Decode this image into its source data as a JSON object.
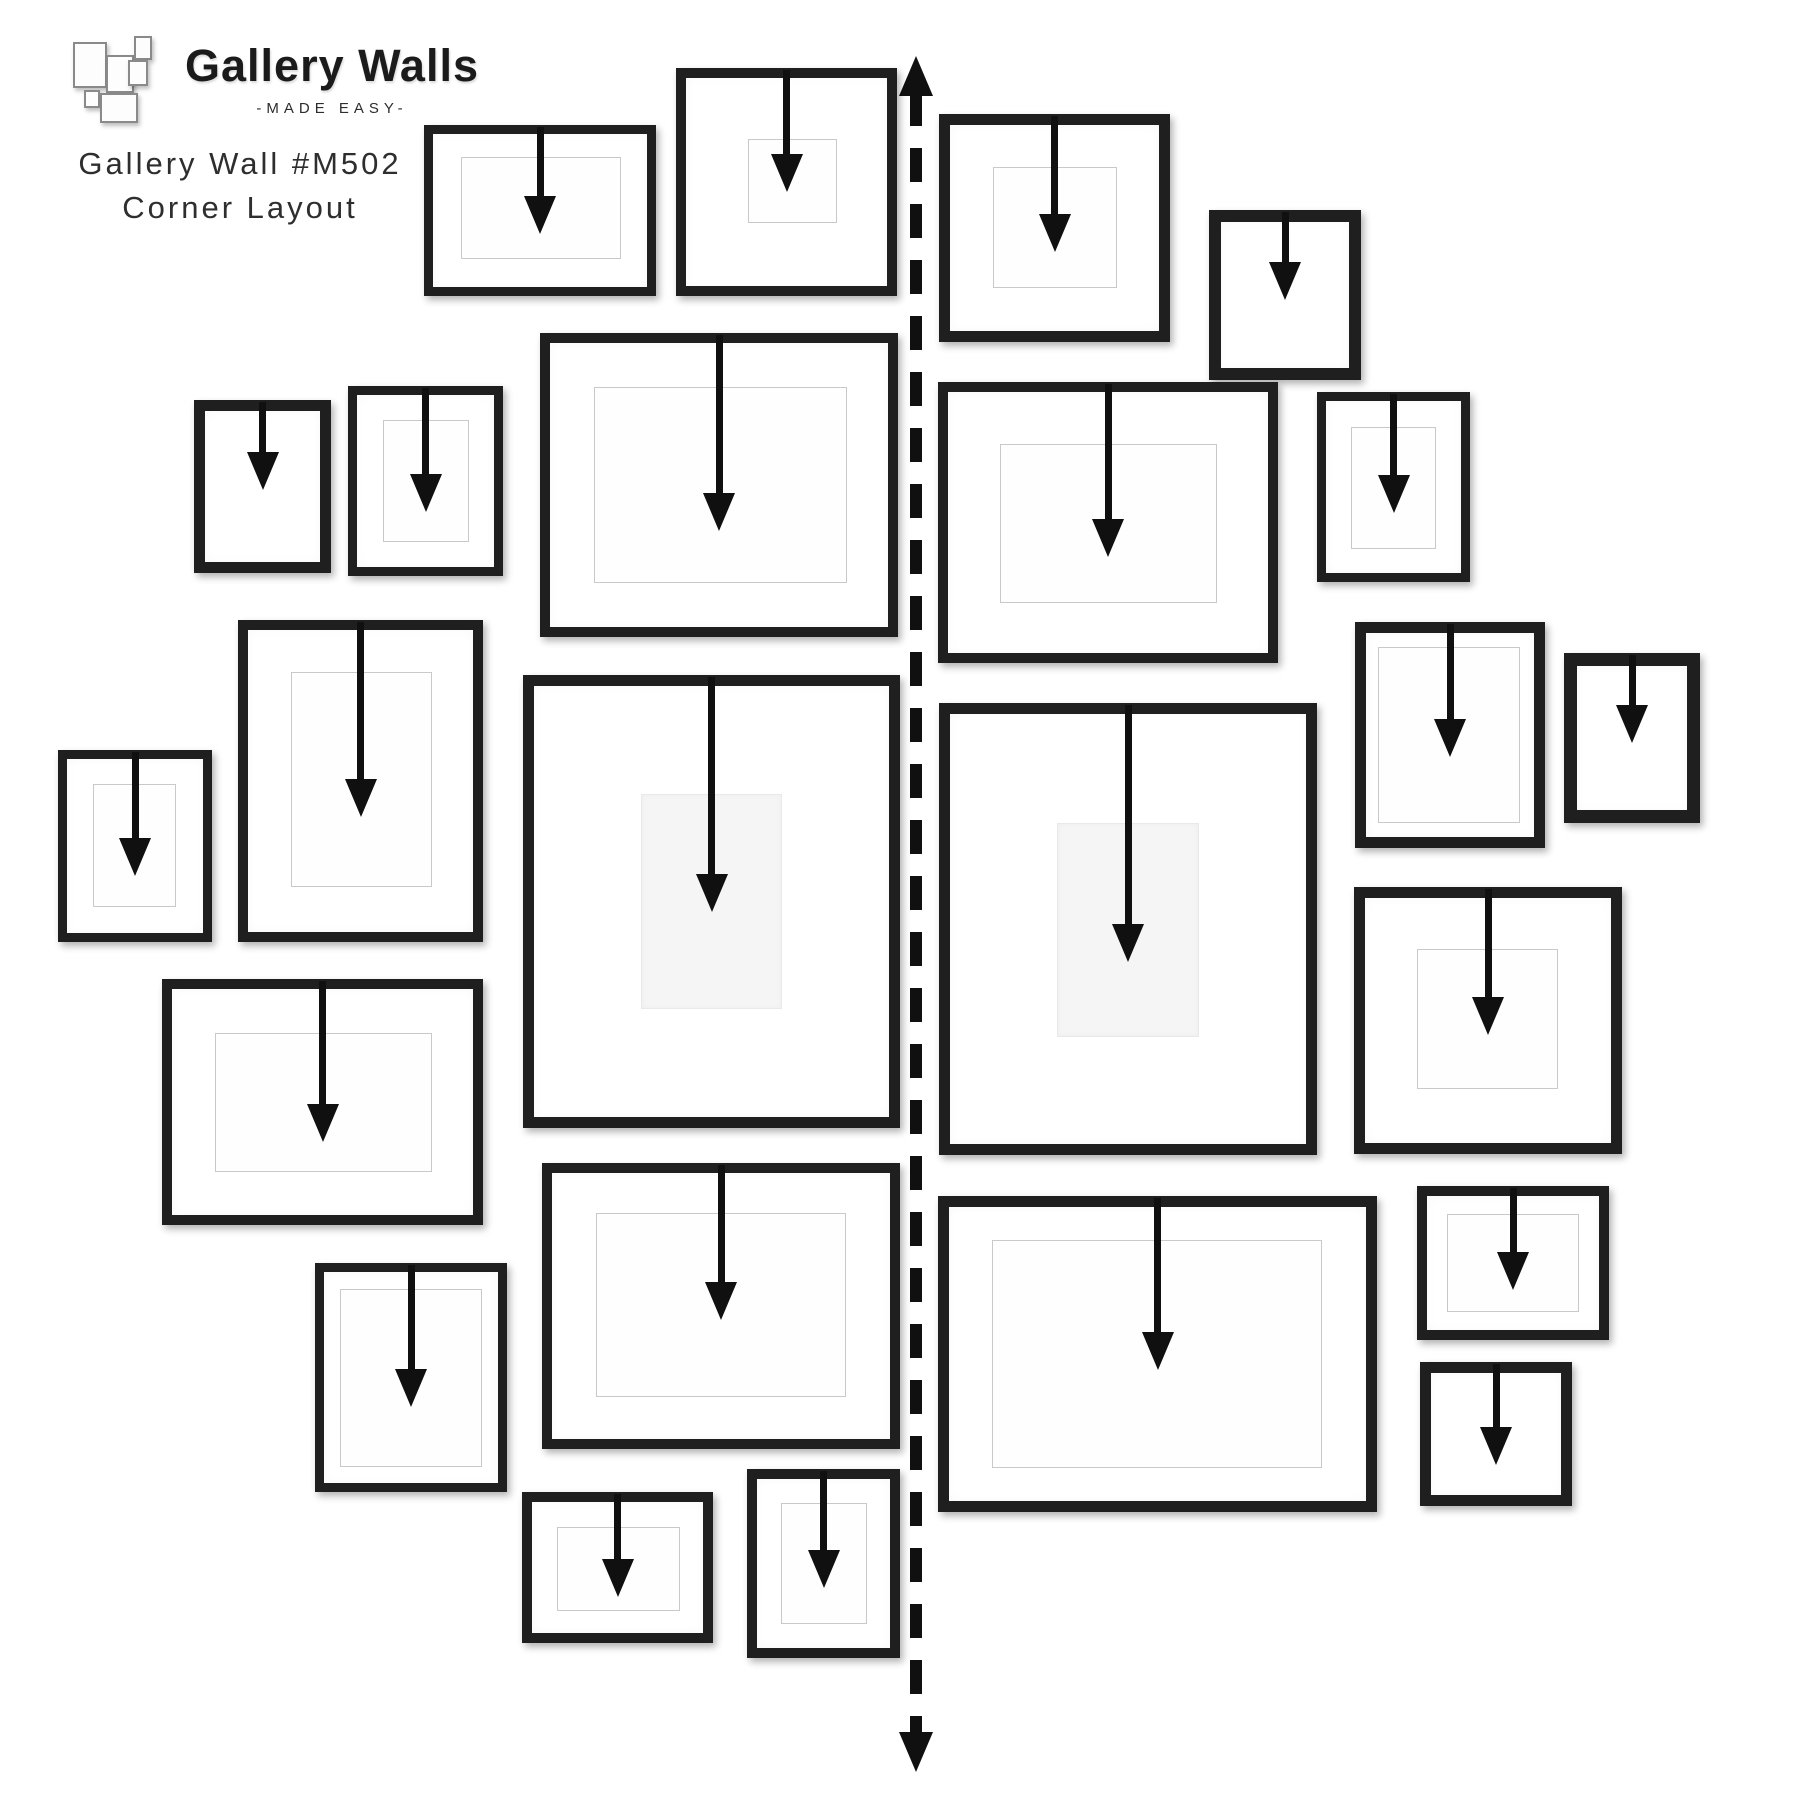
{
  "page": {
    "background": "#ffffff"
  },
  "header": {
    "brand": "Gallery Walls",
    "tagline": "-MADE EASY-",
    "wall_id": "Gallery Wall #M502",
    "layout_name": "Corner Layout",
    "logo_marks": [
      [
        5,
        8,
        30,
        42
      ],
      [
        38,
        21,
        24,
        34
      ],
      [
        66,
        2,
        14,
        20
      ],
      [
        60,
        26,
        16,
        22
      ],
      [
        16,
        56,
        12,
        14
      ],
      [
        32,
        59,
        34,
        26
      ]
    ]
  },
  "style": {
    "frame_color": "#1f1f1f",
    "arrow_color": "#101010",
    "mat_line_color": "#c9c9c9",
    "mat_soft_color": "#f5f5f5",
    "divider_color": "#101010"
  },
  "divider": {
    "x": 916,
    "width": 12,
    "dash": 34,
    "gap": 22,
    "arrow_top_tip": 56,
    "arrow_bottom_tip": 1772,
    "head_w": 34,
    "head_h": 40
  },
  "arrow_spec": {
    "stem_width": 7,
    "head_width": 32,
    "head_height": 38
  },
  "frames": [
    {
      "id": "frame-1",
      "x": 424,
      "y": 125,
      "w": 232,
      "h": 171,
      "bw": 9,
      "mat": [
        37,
        32,
        160,
        102
      ],
      "mat_style": "line",
      "arrow_tip": 234
    },
    {
      "id": "frame-2",
      "x": 676,
      "y": 68,
      "w": 221,
      "h": 228,
      "bw": 10,
      "mat": [
        72,
        71,
        89,
        84
      ],
      "mat_style": "line",
      "arrow_tip": 192
    },
    {
      "id": "frame-3",
      "x": 194,
      "y": 400,
      "w": 137,
      "h": 173,
      "bw": 11,
      "mat": null,
      "mat_style": null,
      "arrow_tip": 490
    },
    {
      "id": "frame-4",
      "x": 348,
      "y": 386,
      "w": 155,
      "h": 190,
      "bw": 9,
      "mat": [
        35,
        34,
        86,
        122
      ],
      "mat_style": "line",
      "arrow_tip": 512
    },
    {
      "id": "frame-5",
      "x": 540,
      "y": 333,
      "w": 358,
      "h": 304,
      "bw": 10,
      "mat": [
        54,
        54,
        253,
        196
      ],
      "mat_style": "line",
      "arrow_tip": 531
    },
    {
      "id": "frame-6",
      "x": 238,
      "y": 620,
      "w": 245,
      "h": 322,
      "bw": 10,
      "mat": [
        53,
        52,
        141,
        215
      ],
      "mat_style": "line",
      "arrow_tip": 817
    },
    {
      "id": "frame-7",
      "x": 58,
      "y": 750,
      "w": 154,
      "h": 192,
      "bw": 9,
      "mat": [
        35,
        34,
        83,
        123
      ],
      "mat_style": "line",
      "arrow_tip": 876
    },
    {
      "id": "frame-8",
      "x": 523,
      "y": 675,
      "w": 377,
      "h": 453,
      "bw": 11,
      "mat": [
        118,
        119,
        141,
        215
      ],
      "mat_style": "soft",
      "arrow_tip": 912
    },
    {
      "id": "frame-9",
      "x": 162,
      "y": 979,
      "w": 321,
      "h": 246,
      "bw": 10,
      "mat": [
        53,
        54,
        217,
        139
      ],
      "mat_style": "line",
      "arrow_tip": 1142
    },
    {
      "id": "frame-10",
      "x": 315,
      "y": 1263,
      "w": 192,
      "h": 229,
      "bw": 9,
      "mat": [
        25,
        26,
        142,
        178
      ],
      "mat_style": "line",
      "arrow_tip": 1407
    },
    {
      "id": "frame-11",
      "x": 542,
      "y": 1163,
      "w": 358,
      "h": 286,
      "bw": 10,
      "mat": [
        54,
        50,
        250,
        184
      ],
      "mat_style": "line",
      "arrow_tip": 1320
    },
    {
      "id": "frame-12",
      "x": 522,
      "y": 1492,
      "w": 191,
      "h": 151,
      "bw": 10,
      "mat": [
        35,
        35,
        123,
        84
      ],
      "mat_style": "line",
      "arrow_tip": 1597
    },
    {
      "id": "frame-13",
      "x": 747,
      "y": 1469,
      "w": 153,
      "h": 189,
      "bw": 10,
      "mat": [
        34,
        34,
        86,
        121
      ],
      "mat_style": "line",
      "arrow_tip": 1588
    },
    {
      "id": "frame-14",
      "x": 939,
      "y": 114,
      "w": 231,
      "h": 228,
      "bw": 11,
      "mat": [
        54,
        53,
        124,
        121
      ],
      "mat_style": "line",
      "arrow_tip": 252
    },
    {
      "id": "frame-15",
      "x": 1209,
      "y": 210,
      "w": 152,
      "h": 170,
      "bw": 12,
      "mat": null,
      "mat_style": null,
      "arrow_tip": 300
    },
    {
      "id": "frame-16",
      "x": 938,
      "y": 382,
      "w": 340,
      "h": 281,
      "bw": 10,
      "mat": [
        62,
        62,
        217,
        159
      ],
      "mat_style": "line",
      "arrow_tip": 557
    },
    {
      "id": "frame-17",
      "x": 1317,
      "y": 392,
      "w": 153,
      "h": 190,
      "bw": 9,
      "mat": [
        34,
        35,
        85,
        122
      ],
      "mat_style": "line",
      "arrow_tip": 513
    },
    {
      "id": "frame-18",
      "x": 1355,
      "y": 622,
      "w": 190,
      "h": 226,
      "bw": 11,
      "mat": [
        23,
        25,
        142,
        176
      ],
      "mat_style": "line",
      "arrow_tip": 757
    },
    {
      "id": "frame-19",
      "x": 1564,
      "y": 653,
      "w": 136,
      "h": 170,
      "bw": 13,
      "mat": null,
      "mat_style": null,
      "arrow_tip": 743
    },
    {
      "id": "frame-20",
      "x": 939,
      "y": 703,
      "w": 378,
      "h": 452,
      "bw": 11,
      "mat": [
        118,
        120,
        142,
        214
      ],
      "mat_style": "soft",
      "arrow_tip": 962
    },
    {
      "id": "frame-21",
      "x": 1354,
      "y": 887,
      "w": 268,
      "h": 267,
      "bw": 11,
      "mat": [
        63,
        62,
        141,
        140
      ],
      "mat_style": "line",
      "arrow_tip": 1035
    },
    {
      "id": "frame-22",
      "x": 938,
      "y": 1196,
      "w": 439,
      "h": 316,
      "bw": 11,
      "mat": [
        54,
        44,
        330,
        228
      ],
      "mat_style": "line",
      "arrow_tip": 1370
    },
    {
      "id": "frame-23",
      "x": 1417,
      "y": 1186,
      "w": 192,
      "h": 154,
      "bw": 10,
      "mat": [
        30,
        28,
        132,
        98
      ],
      "mat_style": "line",
      "arrow_tip": 1290
    },
    {
      "id": "frame-24",
      "x": 1420,
      "y": 1362,
      "w": 152,
      "h": 144,
      "bw": 11,
      "mat": null,
      "mat_style": null,
      "arrow_tip": 1465
    }
  ]
}
